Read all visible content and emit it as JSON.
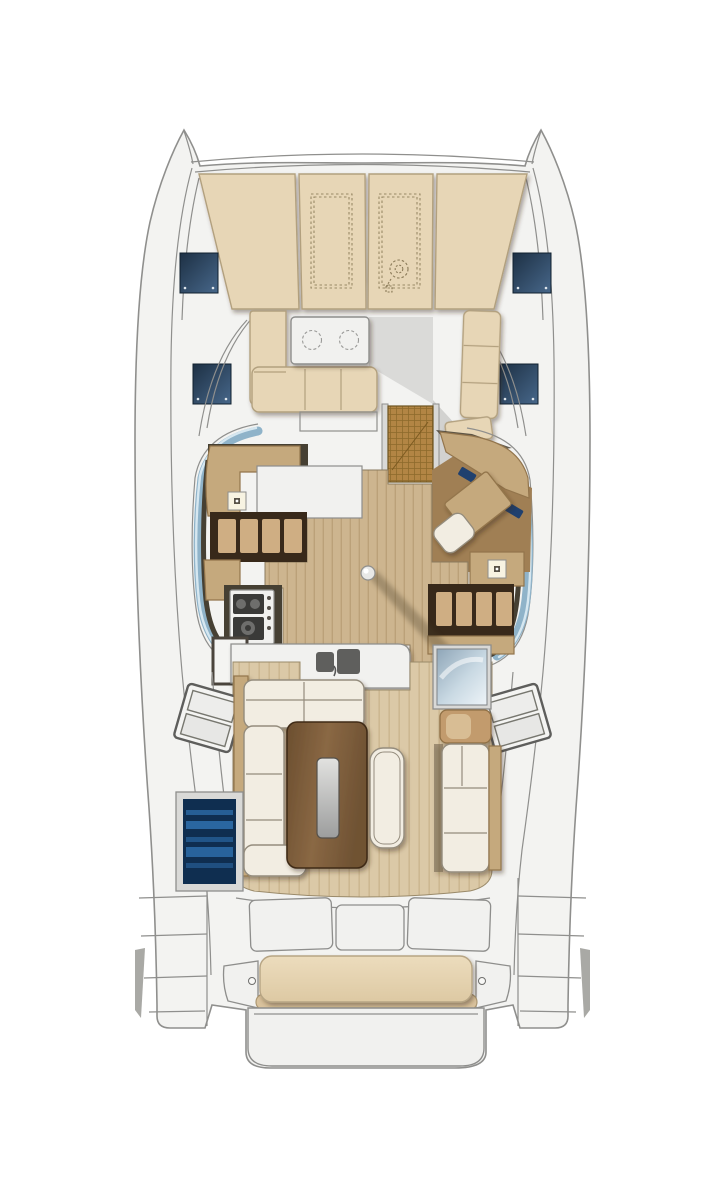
{
  "meta": {
    "title": "Catamaran deck and saloon floor plan",
    "view": "top-down",
    "orientation": "bow at top, stern at bottom"
  },
  "palette": {
    "hullFill": "#f3f3f1",
    "hullLine": "#8f8f8d",
    "panelFill": "#f1f1ef",
    "panelLine": "#8e8e8c",
    "sunpadFill": "#e7d6b6",
    "sunpadLine": "#b2a07e",
    "hatchDark": "#203448",
    "hatchLight": "#41607e",
    "glass": "#8fb3c9",
    "glassHi": "#d6e7f0",
    "woodTrim": "#c5a97d",
    "woodTrimLine": "#93754c",
    "woodDark": "#6d5334",
    "cubbyBg": "#38291a",
    "cubbyTan": "#cfae83",
    "floorSalon": "#cdb58f",
    "floorSalonLine": "#bba179",
    "floorCockpit": "#dbc9a7",
    "floorCockpitLine": "#cdb891",
    "navFloor": "#a07f54",
    "cream": "#f2ede2",
    "creamLine": "#948c7d",
    "tableWood": "#7b5c3a",
    "tableWoodHi": "#9a7850",
    "tableInsertA": "#dcdcda",
    "tableInsertB": "#9fa0a0",
    "fridgeBody": "#0f2e50",
    "fridgeStripe": "#2a66a0",
    "frame": "#d9d9d7",
    "frameLine": "#8e8e8c",
    "matBg": "#b28544",
    "matLine": "#8d6a2c",
    "stoveDark": "#3a3a38",
    "sinkBasin": "#5f5f5d",
    "screenBlue": "#20406e",
    "darkWall": "#464033"
  },
  "regions": {
    "foredeck": {
      "name": "Foredeck with sunpad cushions",
      "sunpad_panels": 4,
      "storage_outlines": 2,
      "windlass": 1,
      "deck_hatches": 4
    },
    "forward_cockpit": {
      "name": "Forward cockpit lounge",
      "table_cupholders": 2,
      "benches": 2,
      "companionway_mat": 1
    },
    "saloon": {
      "name": "Saloon with galley and navigation station",
      "stove_burners": 3,
      "sinks": 2,
      "galley_knobs": 3,
      "storage_cubbies_port": 4,
      "storage_cubbies_starboard": 4,
      "nav_screens": 4,
      "nav_desk": 1,
      "nav_seat": 1,
      "ceiling_spotlights": 2,
      "mast_post": 1
    },
    "aft_cockpit": {
      "name": "Aft cockpit",
      "sofa": "L-shaped",
      "dining_table": 1,
      "movable_bench": 1,
      "fridge_unit": 1,
      "glass_module": 1,
      "side_steps": 2
    },
    "stern": {
      "name": "Stern platform",
      "aft_lockers": 3,
      "helm_bench_cushion": 1,
      "swim_platform": 1
    }
  }
}
